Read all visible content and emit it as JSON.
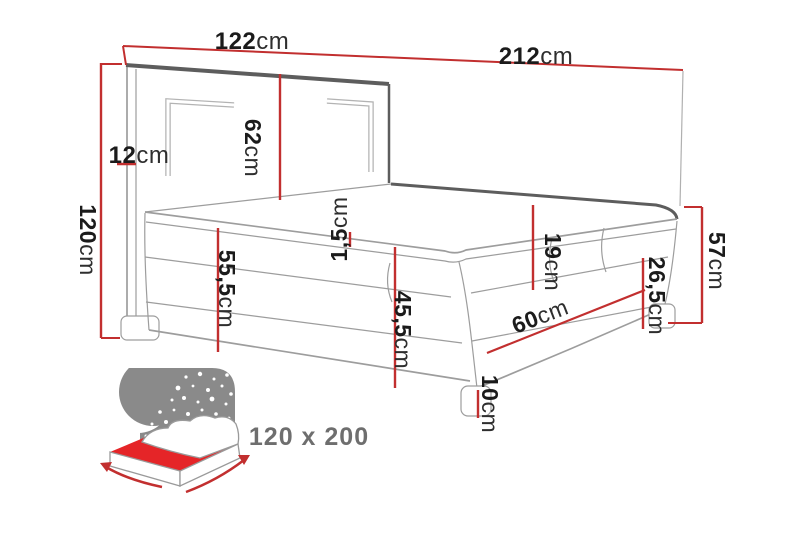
{
  "colors": {
    "background": "#ffffff",
    "dimension_red": "#c22f2f",
    "line_gray": "#9d9d9d",
    "edge_dark_gray": "#5d5d5d",
    "label_dark": "#1b1b1b",
    "icon_gray": "#8a8a8a",
    "icon_mattress_red": "#e52528",
    "footer_text_gray": "#6e6e6e"
  },
  "diagram": {
    "dimensions": {
      "headboard_width": {
        "value": "122",
        "unit": "cm"
      },
      "total_length": {
        "value": "212",
        "unit": "cm"
      },
      "headboard_panel_height": {
        "value": "62",
        "unit": "cm"
      },
      "headboard_depth": {
        "value": "12",
        "unit": "cm"
      },
      "total_height": {
        "value": "120",
        "unit": "cm"
      },
      "side_height_left": {
        "value": "55,5",
        "unit": "cm"
      },
      "topper_thickness": {
        "value": "1,5",
        "unit": "cm"
      },
      "front_height": {
        "value": "45,5",
        "unit": "cm"
      },
      "mattress_thickness": {
        "value": "19",
        "unit": "cm"
      },
      "foot_panel_width": {
        "value": "60",
        "unit": "cm"
      },
      "base_height_right": {
        "value": "26,5",
        "unit": "cm"
      },
      "side_height_right": {
        "value": "57",
        "unit": "cm"
      },
      "leg_height": {
        "value": "10",
        "unit": "cm"
      }
    }
  },
  "footer": {
    "size_label": "120 x 200"
  }
}
